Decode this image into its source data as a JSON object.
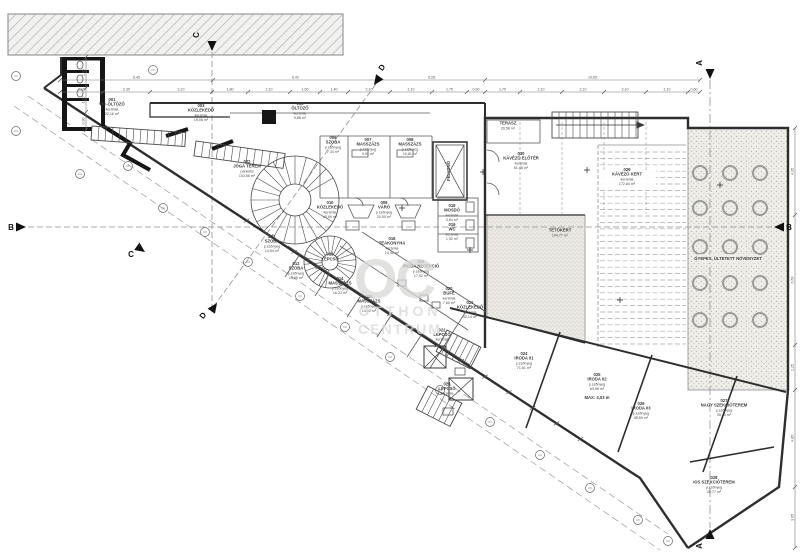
{
  "watermark": {
    "logo": "OC",
    "line1": "OTTHON",
    "line2": "CENTRUM",
    "color": "#d8d8d5"
  },
  "colors": {
    "line": "#4a4a4a",
    "wall": "#2e2e2e",
    "poche": "#161616",
    "dim": "#777777",
    "dashed": "#8f8f8f",
    "hatch_bg": "#f1f1ef",
    "hatch_line": "#b3b3b3",
    "stipple_bg": "#eeede8",
    "stipple_dot": "#b3b3ab"
  },
  "rooms": [
    {
      "id": "001",
      "name": "WC-ÖLTÖZŐ",
      "mat": "kerámia",
      "area": "22,16 m²",
      "x": 112,
      "y": 108
    },
    {
      "id": "003",
      "name": "KÖZLEKEDŐ",
      "mat": "kerámia",
      "area": "19,06 m²",
      "x": 201,
      "y": 114
    },
    {
      "id": "005",
      "name": "ÖLTÖZŐ",
      "mat": "kerámia",
      "area": "9,88 m²",
      "x": 300,
      "y": 112
    },
    {
      "id": "002",
      "name": "JÓGA TEREM",
      "mat": "parketta",
      "area": "103,56 m²",
      "x": 247,
      "y": 170
    },
    {
      "id": "006",
      "name": "SZOBA",
      "mat": "p.szőnyeg",
      "area": "7,34 m²",
      "x": 333,
      "y": 146
    },
    {
      "id": "007",
      "name": "MASSZÁZS",
      "mat": "p.szőnyeg",
      "area": "9,91 m²",
      "x": 368,
      "y": 148
    },
    {
      "id": "008",
      "name": "MASSZÁZS",
      "mat": "p.szőnyeg",
      "area": "10,81 m²",
      "x": 410,
      "y": 148
    },
    {
      "id": "010",
      "name": "KÖZLEKEDŐ",
      "mat": "kerámia",
      "area": "40,69 m²",
      "x": 330,
      "y": 211
    },
    {
      "id": "009",
      "name": "VÁRÓ",
      "mat": "p.szőnyeg",
      "area": "20,50 m²",
      "x": 384,
      "y": 211
    },
    {
      "id": "011",
      "name": "SZOBA",
      "mat": "p.szőnyeg",
      "area": "14,54 m²",
      "x": 272,
      "y": 245
    },
    {
      "id": "012",
      "name": "SZOBA",
      "mat": "p.szőnyeg",
      "area": "16,85 m²",
      "x": 296,
      "y": 272
    },
    {
      "id": "013",
      "name": "LÉPCSŐ",
      "mat": "",
      "area": "",
      "x": 330,
      "y": 258
    },
    {
      "id": "014",
      "name": "MASSZÁZS",
      "mat": "p.szőnyeg",
      "area": "16,23 m²",
      "x": 340,
      "y": 287
    },
    {
      "id": "015",
      "name": "MASSZÁZS",
      "mat": "p.szőnyeg",
      "area": "14,92 m²",
      "x": 369,
      "y": 305
    },
    {
      "id": "016",
      "name": "TEAKONYHA",
      "mat": "kerámia",
      "area": "13,42 m²",
      "x": 392,
      "y": 247
    },
    {
      "id": "017",
      "name": "IRODA RECEPCIÓ",
      "mat": "p.szőnyeg",
      "area": "17,52 m²",
      "x": 421,
      "y": 270
    },
    {
      "id": "018",
      "name": "MOSDÓ",
      "mat": "kerámia",
      "area": "3,84 m²",
      "x": 452,
      "y": 214
    },
    {
      "id": "019",
      "name": "WC",
      "mat": "kerámia",
      "area": "1,92 m²",
      "x": 452,
      "y": 233
    },
    {
      "id": "020",
      "name": "BÜFÉ",
      "mat": "kerámia",
      "area": "7,60 m²",
      "x": 449,
      "y": 297
    },
    {
      "id": "021",
      "name": "KÖZLEKEDŐ",
      "mat": "kerámia",
      "area": "32,14 m²",
      "x": 470,
      "y": 311
    },
    {
      "id": "022",
      "name": "LÉPCSŐ",
      "mat": "kerámia",
      "area": "",
      "x": 442,
      "y": 336
    },
    {
      "id": "023",
      "name": "LÉPCSŐ",
      "mat": "kerámia",
      "area": "",
      "x": 447,
      "y": 390
    },
    {
      "id": "024",
      "name": "IRODA 01",
      "mat": "p.szőnyeg",
      "area": "71,81 m²",
      "x": 524,
      "y": 362
    },
    {
      "id": "025",
      "name": "IRODA 02",
      "mat": "p.szőnyeg",
      "area": "63,96 m²",
      "x": 597,
      "y": 383
    },
    {
      "id": "026",
      "name": "IRODA 03",
      "mat": "p.szőnyeg",
      "area": "55,69 m²",
      "x": 641,
      "y": 412
    },
    {
      "id": "027",
      "name": "NAGY SZEKCIÓTEREM",
      "mat": "p.szőnyeg",
      "area": "35,40 m²",
      "x": 724,
      "y": 409
    },
    {
      "id": "028",
      "name": "KIS SZEKCIÓTEREM",
      "mat": "p.szőnyeg",
      "area": "26,77 m²",
      "x": 714,
      "y": 486
    },
    {
      "id": "029",
      "name": "KÁVÉZÓ KERT",
      "mat": "kerámia",
      "area": "172,84 m²",
      "x": 627,
      "y": 178
    },
    {
      "id": "030",
      "name": "KÁVÉZÓ ELŐTÉR",
      "mat": "kerámia",
      "area": "61,46 m²",
      "x": 521,
      "y": 162
    },
    {
      "id": "",
      "name": "TERASZ",
      "mat": "",
      "area": "20,58 m²",
      "x": 508,
      "y": 127
    },
    {
      "id": "",
      "name": "TETŐKERT",
      "mat": "",
      "area": "104,77 m²",
      "x": 560,
      "y": 234
    },
    {
      "id": "",
      "name": "FELVONÓ",
      "mat": "",
      "area": "",
      "x": 450,
      "y": 171,
      "rot": -90
    },
    {
      "id": "",
      "name": "MAX: 4,03 m",
      "mat": "",
      "area": "",
      "x": 597,
      "y": 399
    },
    {
      "id": "",
      "name": "GYEPES, ÜLTETETT NÖVÉNYZET",
      "mat": "",
      "area": "",
      "x": 728,
      "y": 260
    }
  ],
  "markers": [
    {
      "label": "A",
      "x": 702,
      "y": 63,
      "rot": -90,
      "tx": 710,
      "ty": 79,
      "ta": 90
    },
    {
      "label": "A",
      "x": 702,
      "y": 546,
      "rot": -90,
      "tx": 710,
      "ty": 529,
      "ta": -90
    },
    {
      "label": "B",
      "x": 11,
      "y": 230,
      "rot": 0,
      "tx": 26,
      "ty": 227,
      "ta": 0
    },
    {
      "label": "B",
      "x": 789,
      "y": 230,
      "rot": 0,
      "tx": 774,
      "ty": 227,
      "ta": 180
    },
    {
      "label": "C",
      "x": 199,
      "y": 35,
      "rot": -90,
      "tx": 212,
      "ty": 51,
      "ta": 90
    },
    {
      "label": "C",
      "x": 131,
      "y": 257,
      "rot": 0,
      "tx": 145,
      "ty": 252,
      "ta": 35
    },
    {
      "label": "D",
      "x": 384,
      "y": 69,
      "rot": -55,
      "tx": 374,
      "ty": 85,
      "ta": 125
    },
    {
      "label": "D",
      "x": 205,
      "y": 317,
      "rot": -55,
      "tx": 217,
      "ty": 303,
      "ta": -55
    }
  ],
  "dims": [
    {
      "dir": "h",
      "pos": 80,
      "ticks": [
        60,
        213,
        378,
        485,
        700
      ],
      "labels": [
        "8,45",
        "6,42",
        "5,28",
        "10,65"
      ]
    },
    {
      "dir": "h",
      "pos": 92,
      "ticks": [
        60,
        103,
        150,
        212,
        248,
        290,
        320,
        348,
        390,
        432,
        467,
        485,
        520,
        562,
        604,
        646,
        688,
        700
      ],
      "labels": [
        "2,15",
        "2,35",
        "3,10",
        "1,80",
        "2,10",
        "1,50",
        "1,40",
        "2,10",
        "2,10",
        "1,75",
        "0,90",
        "1,75",
        "2,10",
        "2,10",
        "2,10",
        "2,10",
        "0,60"
      ]
    },
    {
      "dir": "v",
      "pos": 795,
      "ticks": [
        128,
        215,
        345,
        390,
        487,
        548
      ],
      "labels": [
        "4,35",
        "6,50",
        "2,25",
        "4,85",
        "3,05"
      ]
    },
    {
      "dir": "v",
      "pos": 86,
      "ticks": [
        57,
        88,
        112,
        130
      ],
      "labels": [
        "1,55",
        "1,20",
        "0,90"
      ]
    }
  ],
  "trees": {
    "cols": [
      700,
      730,
      760
    ],
    "rows": [
      173,
      208,
      247,
      283,
      320
    ],
    "r": 7
  },
  "survey_points": [
    [
      16,
      76
    ],
    [
      16,
      131
    ],
    [
      80,
      174
    ],
    [
      153,
      70
    ],
    [
      128,
      166
    ],
    [
      163,
      208
    ],
    [
      205,
      232
    ],
    [
      248,
      262
    ],
    [
      300,
      296
    ],
    [
      345,
      327
    ],
    [
      390,
      357
    ],
    [
      440,
      390
    ],
    [
      490,
      422
    ],
    [
      540,
      455
    ],
    [
      590,
      488
    ],
    [
      638,
      520
    ],
    [
      668,
      541
    ]
  ]
}
